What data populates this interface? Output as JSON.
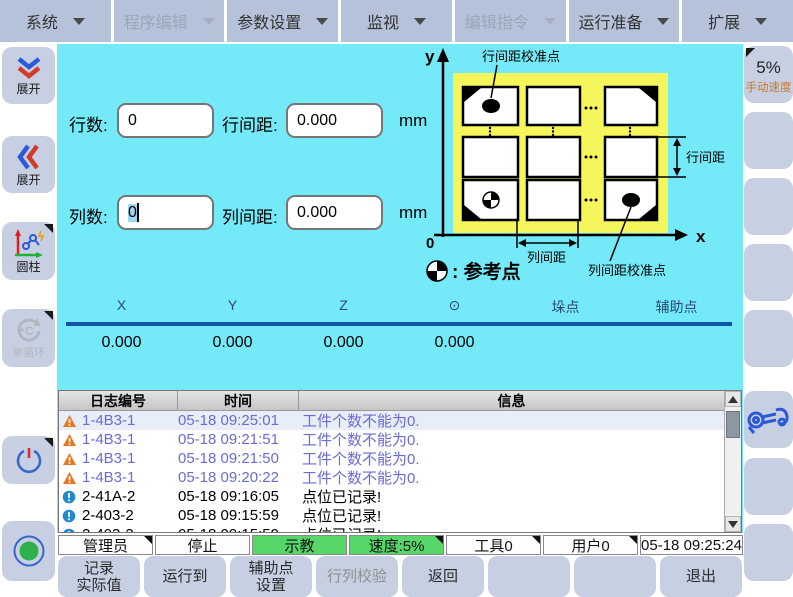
{
  "menu": {
    "items": [
      {
        "label": "系统",
        "enabled": true
      },
      {
        "label": "程序编辑",
        "enabled": false
      },
      {
        "label": "参数设置",
        "enabled": true
      },
      {
        "label": "监视",
        "enabled": true
      },
      {
        "label": "编辑指令",
        "enabled": false
      },
      {
        "label": "运行准备",
        "enabled": true
      },
      {
        "label": "扩展",
        "enabled": true
      }
    ]
  },
  "left_rail": {
    "expand_down_label": "展开",
    "expand_left_label": "展开",
    "cylinder_label": "圆柱",
    "single_cycle_label": "单循环"
  },
  "right_rail": {
    "manual_speed_value": "5%",
    "manual_speed_caption": "手动速度"
  },
  "form": {
    "rows_label": "行数:",
    "rows_value": "0",
    "row_pitch_label": "行间距:",
    "row_pitch_value": "0.000",
    "cols_label": "列数:",
    "cols_value": "0",
    "col_pitch_label": "列间距:",
    "col_pitch_value": "0.000",
    "unit": "mm"
  },
  "diagram": {
    "axis_y": "y",
    "axis_x": "x",
    "origin": "0",
    "row_pitch_cal_label": "行间距校准点",
    "row_pitch_label": "行间距",
    "col_pitch_label": "列间距",
    "col_pitch_cal_label": "列间距校准点",
    "legend_label": ": 参考点"
  },
  "coords": {
    "headers": [
      "X",
      "Y",
      "Z",
      "⊙",
      "垛点",
      "辅助点"
    ],
    "values": [
      "0.000",
      "0.000",
      "0.000",
      "0.000"
    ],
    "stack_dot_color": "#17a74e",
    "aux_dot_color": "#ee1111"
  },
  "log": {
    "headers": [
      "日志编号",
      "时间",
      "信息"
    ],
    "rows": [
      {
        "level": "warning",
        "id": "1-4B3-1",
        "time": "05-18 09:25:01",
        "message": "工件个数不能为0.",
        "selected": true
      },
      {
        "level": "warning",
        "id": "1-4B3-1",
        "time": "05-18 09:21:51",
        "message": "工件个数不能为0."
      },
      {
        "level": "warning",
        "id": "1-4B3-1",
        "time": "05-18 09:21:50",
        "message": "工件个数不能为0."
      },
      {
        "level": "warning",
        "id": "1-4B3-1",
        "time": "05-18 09:20:22",
        "message": "工件个数不能为0."
      },
      {
        "level": "info",
        "id": "2-41A-2",
        "time": "05-18 09:16:05",
        "message": "点位已记录!"
      },
      {
        "level": "info",
        "id": "2-403-2",
        "time": "05-18 09:15:59",
        "message": "点位已记录!"
      },
      {
        "level": "info",
        "id": "2-403-2",
        "time": "05-18 09:15:59",
        "message": "点位已记录!",
        "partial": true
      }
    ]
  },
  "status": {
    "user": "管理员",
    "run_state": "停止",
    "mode": "示教",
    "speed": "速度:5%",
    "tool": "工具0",
    "frame": "用户0",
    "datetime": "05-18 09:25:24"
  },
  "bottom": {
    "buttons": [
      {
        "line1": "记录",
        "line2": "实际值",
        "enabled": true
      },
      {
        "line1": "运行到",
        "line2": "",
        "enabled": true
      },
      {
        "line1": "辅助点",
        "line2": "设置",
        "enabled": true
      },
      {
        "line1": "行列校验",
        "line2": "",
        "enabled": false
      },
      {
        "line1": "返回",
        "line2": "",
        "enabled": true
      },
      {
        "line1": "",
        "line2": "",
        "enabled": true
      },
      {
        "line1": "",
        "line2": "",
        "enabled": true
      },
      {
        "line1": "退出",
        "line2": "",
        "enabled": true
      }
    ]
  },
  "colors": {
    "main_bg": "#74e9f8",
    "diagram_bg": "#f5f55c",
    "menubar_bg": "#b5c2d9",
    "button_bg": "#c7d0e3",
    "mode_green": "#57d769",
    "header_line": "#1254a8",
    "warning_text": "#6b6bd4",
    "warning_icon": "#e87722",
    "info_icon": "#1f8ad2"
  }
}
